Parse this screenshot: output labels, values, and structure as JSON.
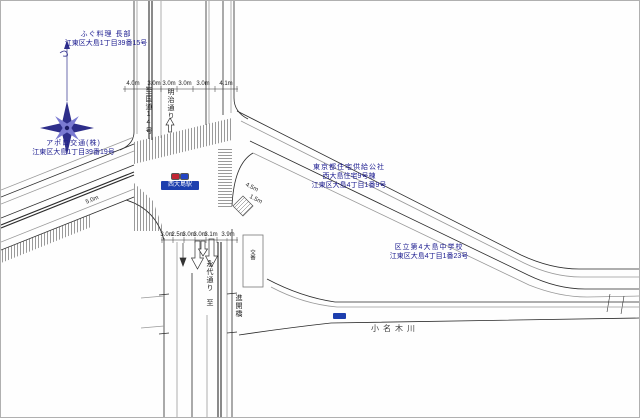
{
  "labels": {
    "fugu": {
      "name": "ふぐ料理 長部",
      "address": "江東区大島1丁目39番15号"
    },
    "apollo": {
      "name": "アポロ交通(株)",
      "address": "江東区大島1丁目39番19号"
    },
    "kousha": {
      "name": "東京都住宅供給公社",
      "building": "西大島住宅9号棟",
      "address": "江東区大島4丁目1番9号"
    },
    "school": {
      "name": "区立第4大島中学校",
      "address": "江東区大島4丁目1番23号"
    },
    "koban": {
      "name": "交番"
    }
  },
  "station": {
    "name": "西大島駅"
  },
  "streets": {
    "vertical_north": {
      "to": "至",
      "name": "国道14号"
    },
    "meiji": {
      "name": "明治通り"
    },
    "vertical_south": {
      "name": "永代通り",
      "to": "至"
    },
    "bridge": {
      "name": "進開橋"
    },
    "river": {
      "name": "小名木川"
    }
  },
  "dimensions": {
    "north_lanes": [
      "4.0m",
      "3.0m",
      "3.0m",
      "3.0m",
      "3.0m",
      "4.1m"
    ],
    "south_lanes": [
      "3.0m",
      "2.5m",
      "3.0m",
      "3.0m",
      "3.1m",
      "3.9m"
    ],
    "west_road": "5.0m",
    "east_road_a": "4.5m",
    "east_road_b": "1.5m"
  },
  "colors": {
    "label_navy": "#1b1b8f",
    "station_badge": "#1d3fae",
    "line_dark": "#2b2b2b",
    "compass": "#2e2e8a"
  }
}
